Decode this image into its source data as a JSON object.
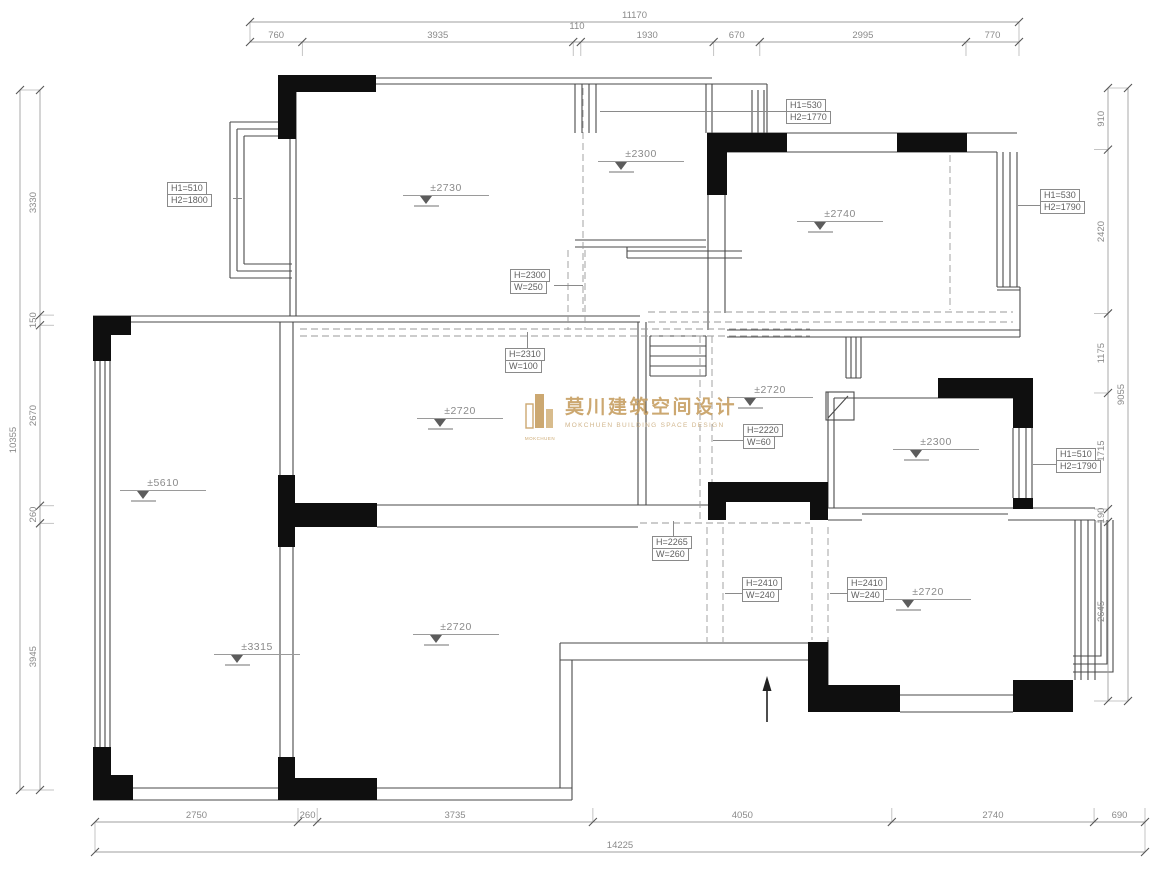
{
  "colors": {
    "wall": "#4a4a4a",
    "column": "#0f0f0f",
    "dim_text": "#8a8a8a",
    "dim_line": "#9f9f9f",
    "dashed": "#9a9a9a",
    "label_text": "#5f5f5f",
    "gold": "#c79f62"
  },
  "watermark": {
    "zh": "莫川建筑空间设计",
    "en": "MOKCHUEN BUILDING SPACE DESIGN",
    "logo_caption": "MOKCHUEN"
  },
  "dimensions": {
    "top": {
      "total": "11170",
      "segments": [
        "760",
        "3935",
        "110",
        "1930",
        "670",
        "2995",
        "770"
      ]
    },
    "left": {
      "total": "10355",
      "segments": [
        "3330",
        "150",
        "2670",
        "260",
        "3945"
      ]
    },
    "right": {
      "total": "9055",
      "segments": [
        "910",
        "2420",
        "1175",
        "1715",
        "190",
        "2645"
      ]
    },
    "bottom": {
      "total": "14225",
      "segments": [
        "2750",
        "260",
        "3735",
        "4050",
        "2740",
        "690"
      ]
    }
  },
  "elevation_markers": [
    {
      "label": "±2730",
      "x": 446,
      "y": 190
    },
    {
      "label": "±2300",
      "x": 641,
      "y": 156
    },
    {
      "label": "±2740",
      "x": 840,
      "y": 216
    },
    {
      "label": "±2720",
      "x": 460,
      "y": 413
    },
    {
      "label": "±2720",
      "x": 770,
      "y": 392
    },
    {
      "label": "±2300",
      "x": 936,
      "y": 444
    },
    {
      "label": "±5610",
      "x": 163,
      "y": 485
    },
    {
      "label": "±2720",
      "x": 928,
      "y": 594
    },
    {
      "label": "±2720",
      "x": 456,
      "y": 629
    },
    {
      "label": "±3315",
      "x": 257,
      "y": 649
    }
  ],
  "leader_labels": [
    {
      "line1": "H1=510",
      "line2": "H2=1800",
      "x": 167,
      "y": 183,
      "leader": {
        "x": 233,
        "y": 198,
        "len": 9,
        "dir": "h"
      }
    },
    {
      "line1": "H1=530",
      "line2": "H2=1770",
      "x": 786,
      "y": 100,
      "leader": {
        "x": 600,
        "y": 111,
        "len": 186,
        "dir": "h"
      }
    },
    {
      "line1": "H1=530",
      "line2": "H2=1790",
      "x": 1040,
      "y": 190,
      "leader": {
        "x": 1018,
        "y": 205,
        "len": 22,
        "dir": "h"
      }
    },
    {
      "line1": "H=2300",
      "line2": "W=250",
      "x": 510,
      "y": 270,
      "leader": {
        "x": 554,
        "y": 285,
        "len": 29,
        "dir": "h"
      }
    },
    {
      "line1": "H=2310",
      "line2": "W=100",
      "x": 505,
      "y": 349,
      "leader": {
        "x": 527,
        "y": 332,
        "len": 17,
        "dir": "v"
      }
    },
    {
      "line1": "H=2220",
      "line2": "W=60",
      "x": 743,
      "y": 425,
      "leader": {
        "x": 713,
        "y": 440,
        "len": 30,
        "dir": "h"
      }
    },
    {
      "line1": "H1=510",
      "line2": "H2=1790",
      "x": 1056,
      "y": 449,
      "leader": {
        "x": 1033,
        "y": 464,
        "len": 23,
        "dir": "h"
      }
    },
    {
      "line1": "H=2265",
      "line2": "W=260",
      "x": 652,
      "y": 537,
      "leader": {
        "x": 673,
        "y": 521,
        "len": 16,
        "dir": "v"
      }
    },
    {
      "line1": "H=2410",
      "line2": "W=240",
      "x": 742,
      "y": 578,
      "leader": {
        "x": 725,
        "y": 593,
        "len": 17,
        "dir": "h"
      }
    },
    {
      "line1": "H=2410",
      "line2": "W=240",
      "x": 847,
      "y": 578,
      "leader": {
        "x": 830,
        "y": 593,
        "len": 17,
        "dir": "h"
      }
    }
  ]
}
